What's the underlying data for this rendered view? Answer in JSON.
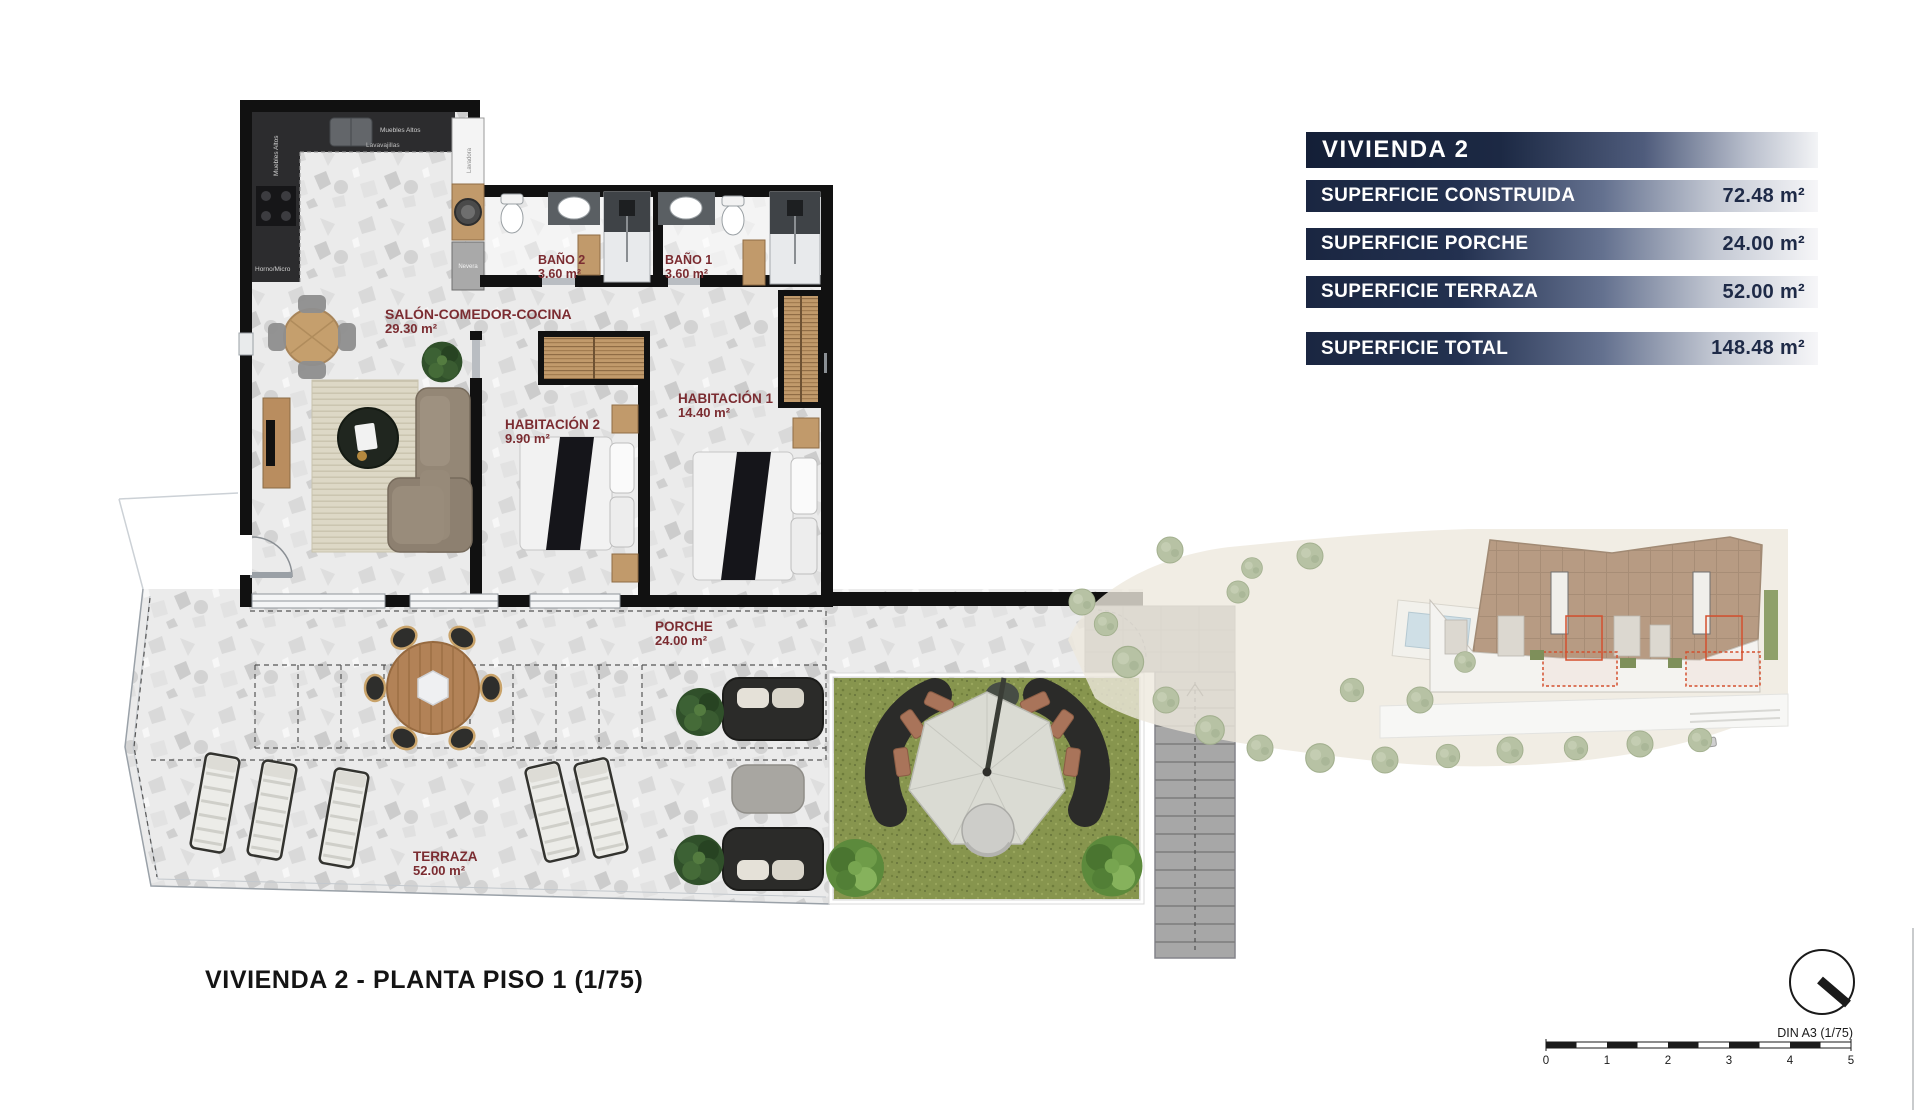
{
  "summary_table": {
    "title": "VIVIENDA 2",
    "rows": [
      {
        "label": "SUPERFICIE CONSTRUIDA",
        "value": "72.48 m²"
      },
      {
        "label": "SUPERFICIE PORCHE",
        "value": "24.00 m²"
      },
      {
        "label": "SUPERFICIE TERRAZA",
        "value": "52.00 m²"
      }
    ],
    "total_row": {
      "label": "SUPERFICIE TOTAL",
      "value": "148.48 m²"
    }
  },
  "floor_plan": {
    "rooms": {
      "salon": {
        "name": "SALÓN-COMEDOR-COCINA",
        "area": "29.30 m²"
      },
      "bano2": {
        "name": "BAÑO 2",
        "area": "3.60 m²"
      },
      "bano1": {
        "name": "BAÑO 1",
        "area": "3.60 m²"
      },
      "hab2": {
        "name": "HABITACIÓN 2",
        "area": "9.90 m²"
      },
      "hab1": {
        "name": "HABITACIÓN 1",
        "area": "14.40 m²"
      },
      "porche": {
        "name": "PORCHE",
        "area": "24.00 m²"
      },
      "terraza": {
        "name": "TERRAZA",
        "area": "52.00 m²"
      }
    },
    "kitchen_labels": {
      "muebles_altos_top": "Muebles Altos",
      "muebles_altos_left": "Muebles Altos",
      "lavavajillas": "Lavavajillas",
      "horno_micro": "Horno/Micro",
      "lavadora": "Lavadora",
      "nevera": "Nevera"
    }
  },
  "footer": {
    "plan_title": "VIVIENDA 2 - PLANTA PISO 1 (1/75)",
    "sheet_label": "DIN A3 (1/75)",
    "scale_ticks": [
      "0",
      "1",
      "2",
      "3",
      "4",
      "5"
    ]
  },
  "colors": {
    "accent_navy": "#1c2944",
    "room_label_red": "#7b2c31",
    "wall_black": "#111111",
    "grass_green": "#87954e",
    "highlight_red": "#d4502e"
  }
}
